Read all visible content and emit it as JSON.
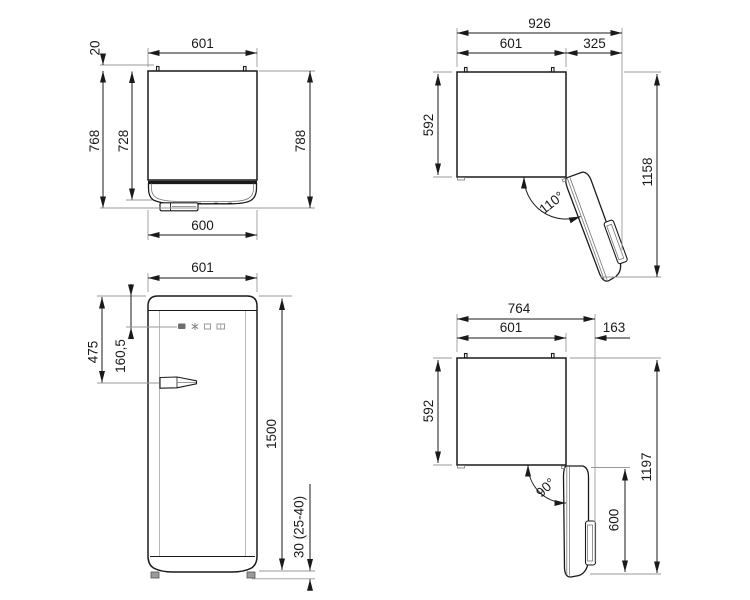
{
  "labels": {
    "top_closed": {
      "width_top": "601",
      "wall_gap": "20",
      "depth_with_door": "768",
      "depth_cabinet": "728",
      "depth_with_handle": "788",
      "width_bottom": "600"
    },
    "top_open_110": {
      "overall_width": "926",
      "body_width": "601",
      "door_protrusion": "325",
      "body_depth": "592",
      "overall_depth": "1158",
      "angle": "110°"
    },
    "front": {
      "width": "601",
      "handle_offset": "475",
      "panel_offset": "160,5",
      "height": "1500",
      "feet_height": "30 (25-40)"
    },
    "top_open_90": {
      "overall_width": "764",
      "body_width": "601",
      "door_protrusion": "163",
      "body_depth": "592",
      "door_length": "600",
      "overall_depth": "1197",
      "angle": "90°"
    }
  },
  "icons": {
    "control_panel": [
      "power-icon",
      "snowflake-icon",
      "display-icon",
      "mode-icon"
    ]
  },
  "colors": {
    "outline": "#1a1a1a",
    "dimension": "#1a1a1a",
    "reference": "#9a9a9a",
    "background": "#ffffff"
  }
}
